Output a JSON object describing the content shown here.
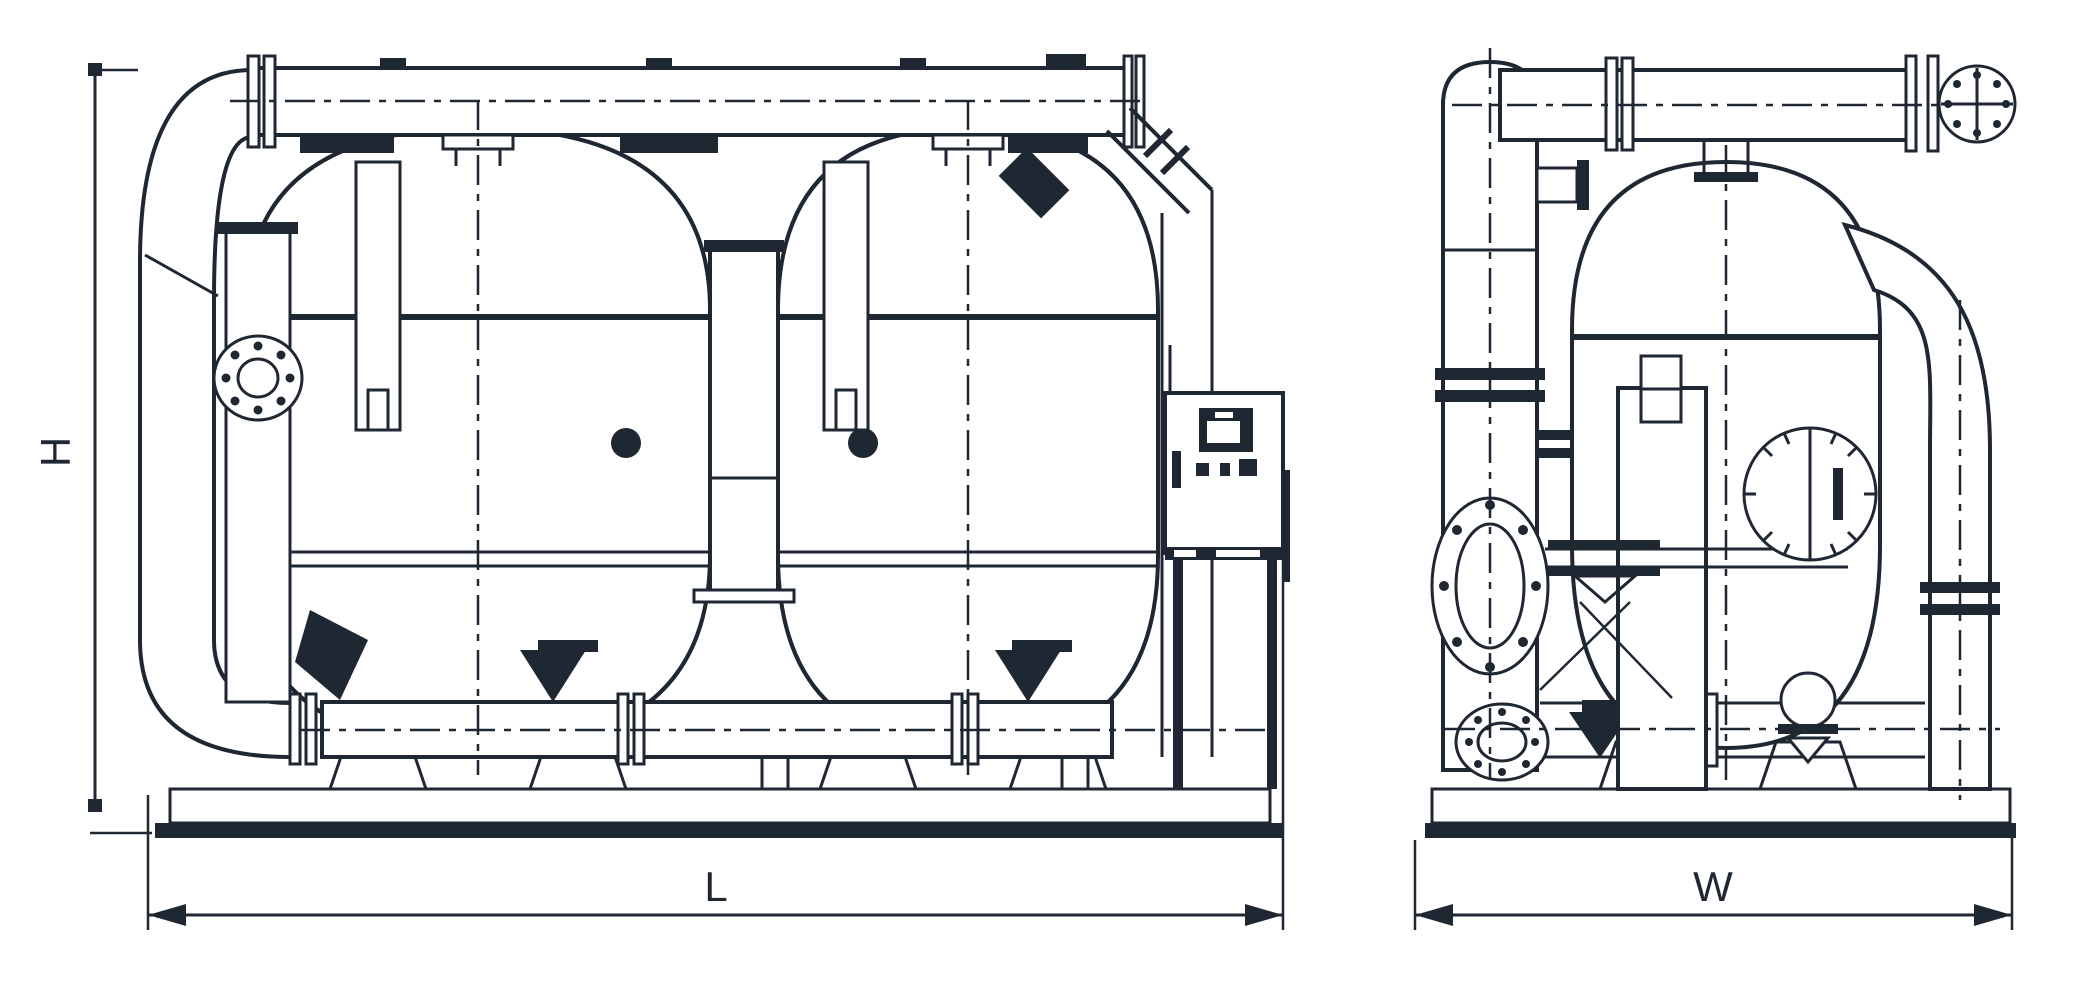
{
  "drawing": {
    "ink_color": "#1f2733",
    "background_color": "#ffffff",
    "labels": {
      "height": "H",
      "length": "L",
      "width": "W"
    }
  }
}
